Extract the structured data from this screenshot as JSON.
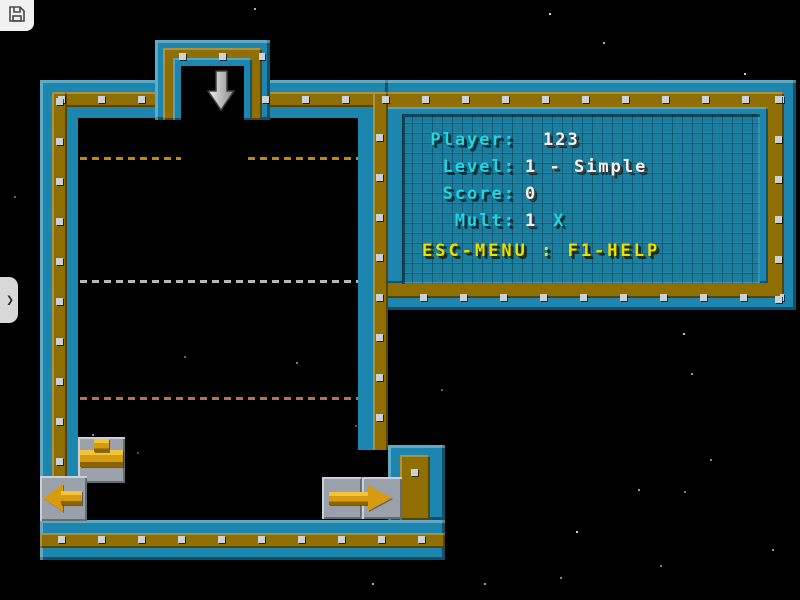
{
  "controls": {
    "save_icon": "floppy-disk",
    "side_tab_chevron": "❯"
  },
  "hud": {
    "rows": [
      {
        "label": "Player:",
        "value": "123"
      },
      {
        "label": "Level:",
        "value": "1 - Simple"
      },
      {
        "label": "Score:",
        "value": "0"
      },
      {
        "label": "Mult:",
        "value": "1",
        "suffix": "X"
      }
    ],
    "help_line": "ESC-MENU : F1-HELP"
  },
  "game": {
    "drop_arrow_icon": "down-arrow",
    "pieces": [
      {
        "type": "tee-pipe",
        "tile": "gray-single"
      },
      {
        "type": "arrow-left",
        "tile": "gray-single"
      },
      {
        "type": "arrow-right",
        "tile": "gray-double"
      }
    ],
    "guide_lines": [
      {
        "y": 158,
        "color": "#c08718"
      },
      {
        "y": 281,
        "color": "#b9b9b9"
      },
      {
        "y": 398,
        "color": "#bd7058"
      }
    ]
  },
  "colors": {
    "blue-mid": "#1d86ae",
    "blue-light": "#2ea3cc",
    "blue-dark": "#0d5571",
    "gold-mid": "#8f6e04",
    "rivet": "#ccd1d5",
    "panel-teal": "#1b7e9f",
    "cyan": "#20d6e4",
    "white-text": "#f2f2f2",
    "yellow": "#e6e300",
    "piece-gold": "#d79b10",
    "tile-gray": "#9aa1aa",
    "background": "#000000"
  },
  "stars": [
    [
      254,
      8,
      "#aab0b6"
    ],
    [
      549,
      13,
      "#dddddd"
    ],
    [
      603,
      42,
      "#aaaaaa"
    ],
    [
      744,
      73,
      "#cccccc"
    ],
    [
      230,
      119,
      "#888888"
    ],
    [
      212,
      143,
      "#777777"
    ],
    [
      184,
      356,
      "#666666"
    ],
    [
      296,
      362,
      "#777777"
    ],
    [
      355,
      425,
      "#555555"
    ],
    [
      441,
      389,
      "#666666"
    ],
    [
      92,
      434,
      "#888888"
    ],
    [
      137,
      452,
      "#555555"
    ],
    [
      683,
      333,
      "#bbbbbb"
    ],
    [
      691,
      373,
      "#999999"
    ],
    [
      638,
      489,
      "#999999"
    ],
    [
      684,
      491,
      "#777777"
    ],
    [
      576,
      531,
      "#cccccc"
    ],
    [
      710,
      459,
      "#888888"
    ],
    [
      772,
      549,
      "#999999"
    ],
    [
      372,
      583,
      "#aaaaaa"
    ],
    [
      484,
      583,
      "#999999"
    ],
    [
      560,
      577,
      "#888888"
    ],
    [
      660,
      565,
      "#777777"
    ],
    [
      14,
      196,
      "#666666"
    ]
  ]
}
